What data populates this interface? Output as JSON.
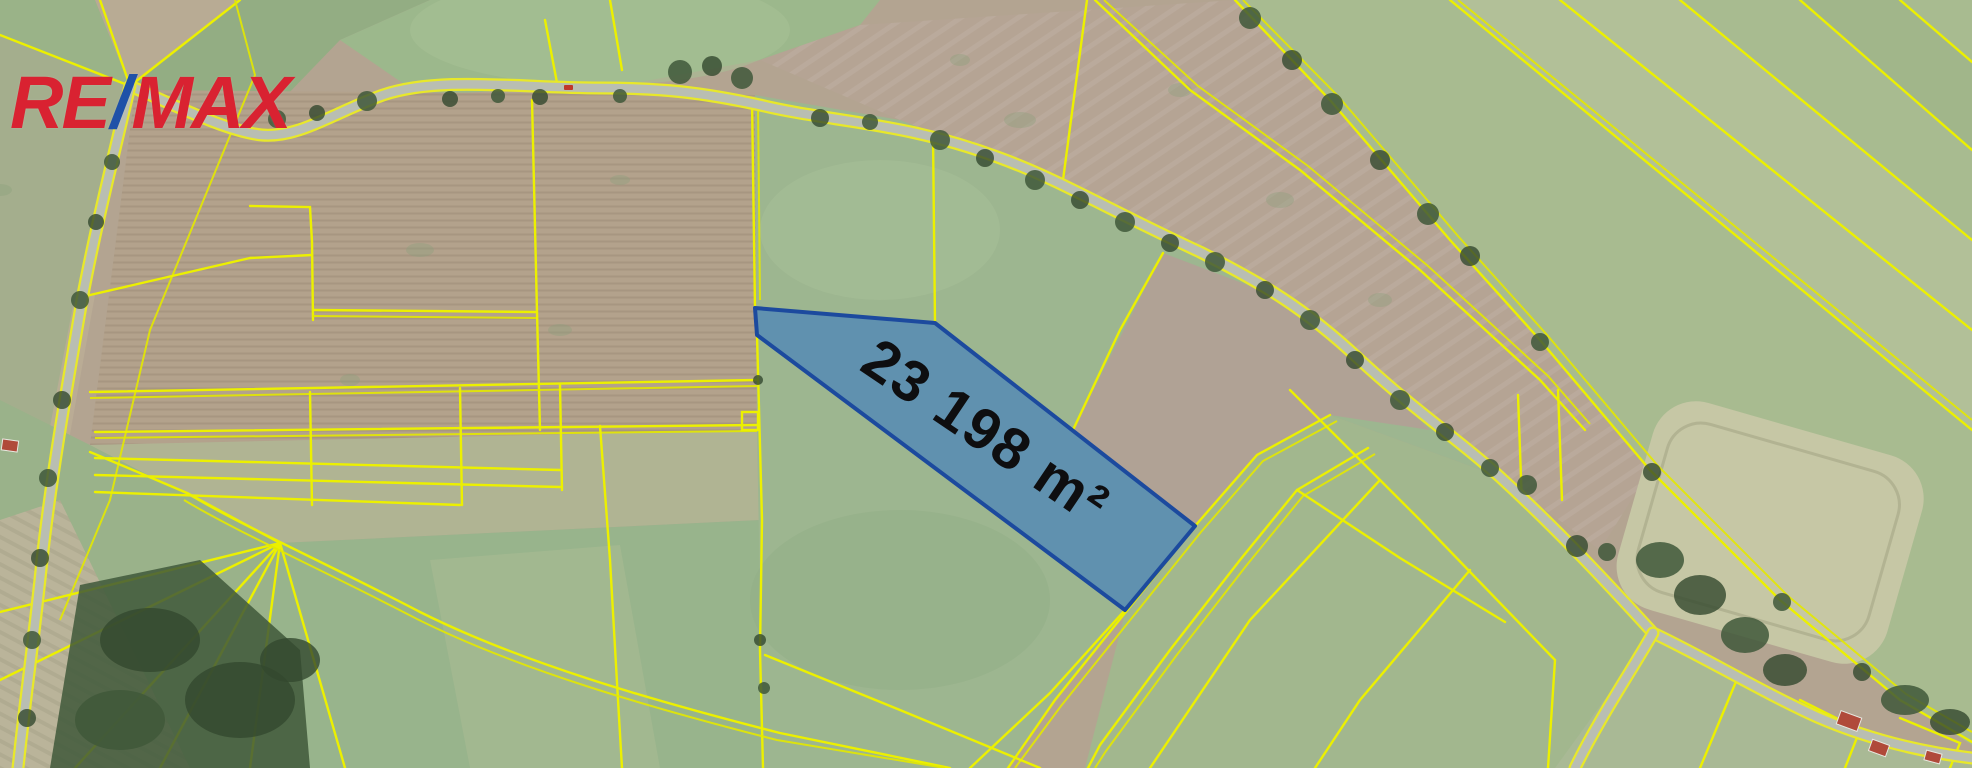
{
  "logo": {
    "re": "RE",
    "slash": "/",
    "max": "MAX"
  },
  "parcel": {
    "area_label": "23 198 m²",
    "fill": "#2d73c8",
    "stroke": "#1c4a9e"
  },
  "map": {
    "boundary_line_color": "#ecf000",
    "road_color": "#b9beb2",
    "logo_red": "#D92231",
    "logo_blue": "#1F51A8",
    "car_color": "#c0372a",
    "building_color": "#b04a3a"
  }
}
